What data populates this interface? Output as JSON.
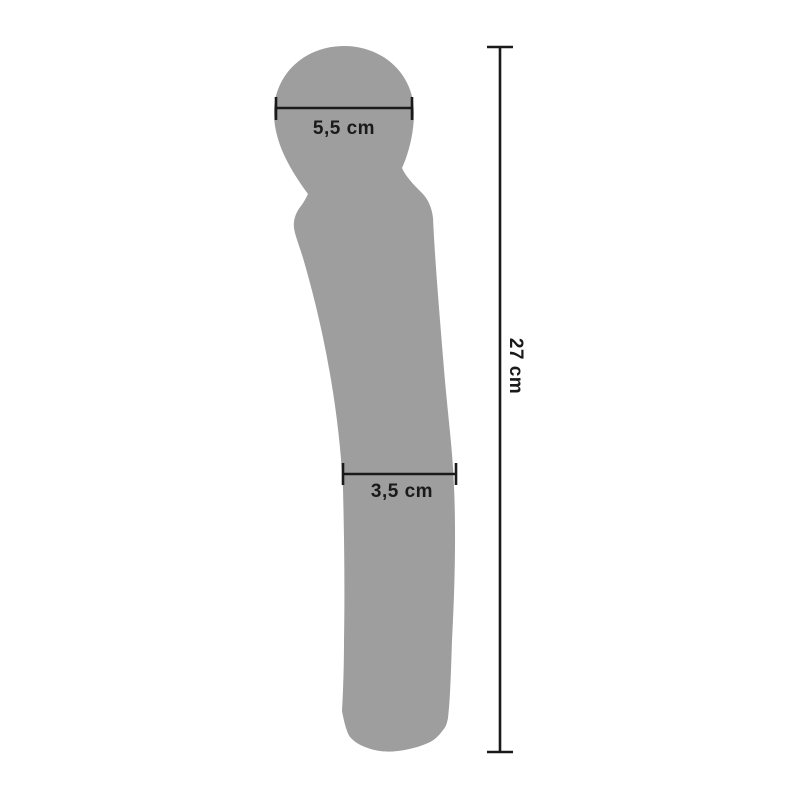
{
  "measurements": {
    "head_width": "5,5 cm",
    "body_width": "3,5 cm",
    "total_length": "27 cm"
  },
  "colors": {
    "silhouette": "#9e9e9e",
    "dimension": "#1a1a1a",
    "background": "#ffffff"
  }
}
